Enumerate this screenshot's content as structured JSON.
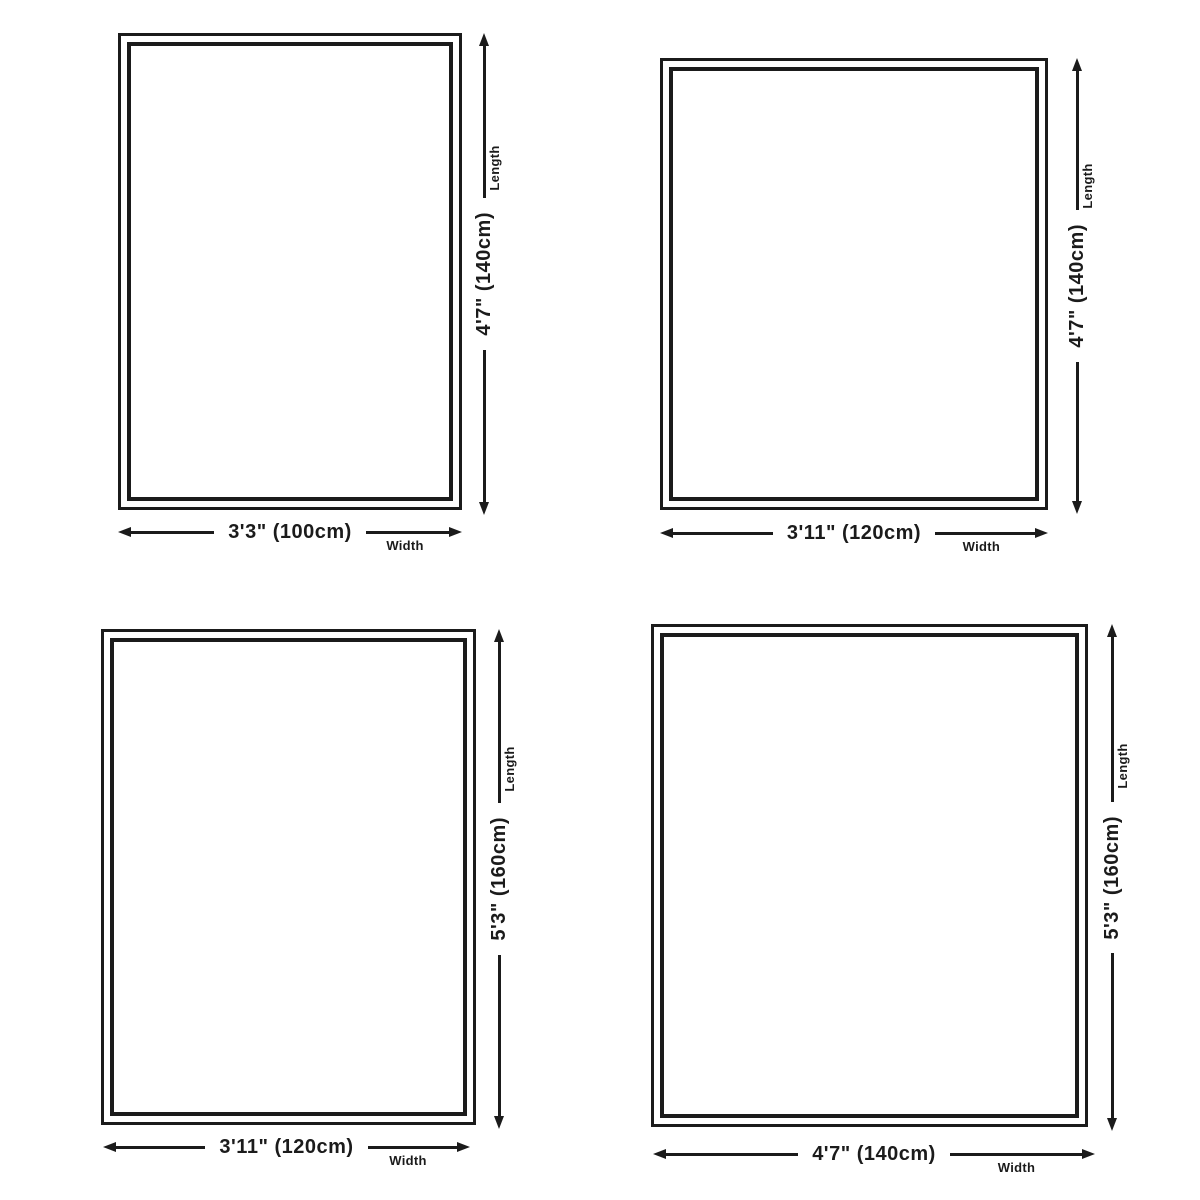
{
  "page": {
    "background": "#ffffff",
    "ink": "#1b1b1b"
  },
  "axis_labels": {
    "length": "Length",
    "width": "Width"
  },
  "sizes": [
    {
      "position": "top-left",
      "width_label": "3'3\" (100cm)",
      "length_label": "4'7\" (140cm)",
      "width_cm": 100,
      "length_cm": 140
    },
    {
      "position": "top-right",
      "width_label": "3'11\" (120cm)",
      "length_label": "4'7\" (140cm)",
      "width_cm": 120,
      "length_cm": 140
    },
    {
      "position": "bottom-left",
      "width_label": "3'11\" (120cm)",
      "length_label": "5'3\" (160cm)",
      "width_cm": 120,
      "length_cm": 160
    },
    {
      "position": "bottom-right",
      "width_label": "4'7\" (140cm)",
      "length_label": "5'3\" (160cm)",
      "width_cm": 140,
      "length_cm": 160
    }
  ]
}
